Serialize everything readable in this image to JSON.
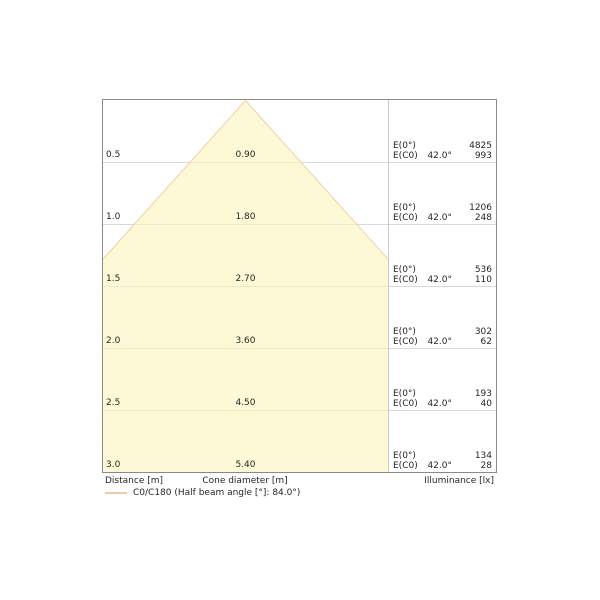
{
  "chart_data": {
    "type": "area",
    "subtype": "luminaire-light-cone-diagram",
    "title": "",
    "xlabel": "Cone diameter [m]",
    "ylabel": "Distance [m]",
    "value_axis_label": "Illuminance [lx]",
    "distances_m": [
      0.5,
      1.0,
      1.5,
      2.0,
      2.5,
      3.0
    ],
    "cone_diameters_m": [
      0.9,
      1.8,
      2.7,
      3.6,
      4.5,
      5.4
    ],
    "illuminance_e0_lx": [
      4825,
      1206,
      536,
      302,
      193,
      134
    ],
    "illuminance_ec0_lx": [
      993,
      248,
      110,
      62,
      40,
      28
    ],
    "beam_half_angle_deg": 42.0,
    "half_beam_angle_full_deg": 84.0,
    "legend": {
      "label": "C0/C180 (Half beam angle [°]: 84.0°)",
      "swatch_color": "#f2c9a0"
    },
    "footer": {
      "distance_label": "Distance [m]",
      "cone_diameter_label": "Cone diameter [m]",
      "illuminance_label": "Illuminance [lx]"
    },
    "columns": {
      "e0_label": "E(0°)",
      "ec0_label": "E(C0)"
    },
    "rows": [
      {
        "distance": "0.5",
        "diameter": "0.90",
        "angle": "42.0°",
        "e0": "4825",
        "ec0": "993"
      },
      {
        "distance": "1.0",
        "diameter": "1.80",
        "angle": "42.0°",
        "e0": "1206",
        "ec0": "248"
      },
      {
        "distance": "1.5",
        "diameter": "2.70",
        "angle": "42.0°",
        "e0": "536",
        "ec0": "110"
      },
      {
        "distance": "2.0",
        "diameter": "3.60",
        "angle": "42.0°",
        "e0": "302",
        "ec0": "62"
      },
      {
        "distance": "2.5",
        "diameter": "4.50",
        "angle": "42.0°",
        "e0": "193",
        "ec0": "40"
      },
      {
        "distance": "3.0",
        "diameter": "5.40",
        "angle": "42.0°",
        "e0": "134",
        "ec0": "28"
      }
    ],
    "colors": {
      "cone_fill": "#fcf6bd",
      "cone_stroke": "#f2c9a0",
      "grid": "#d9d9d9",
      "separator": "#cccccc",
      "border": "#8a8a8a",
      "text": "#262626"
    },
    "layout_hints": {
      "grid": "horizontal lines per 0.5 m row",
      "legend_position": "bottom-left",
      "cone_apex": "top center of left section, clipped to section"
    }
  }
}
